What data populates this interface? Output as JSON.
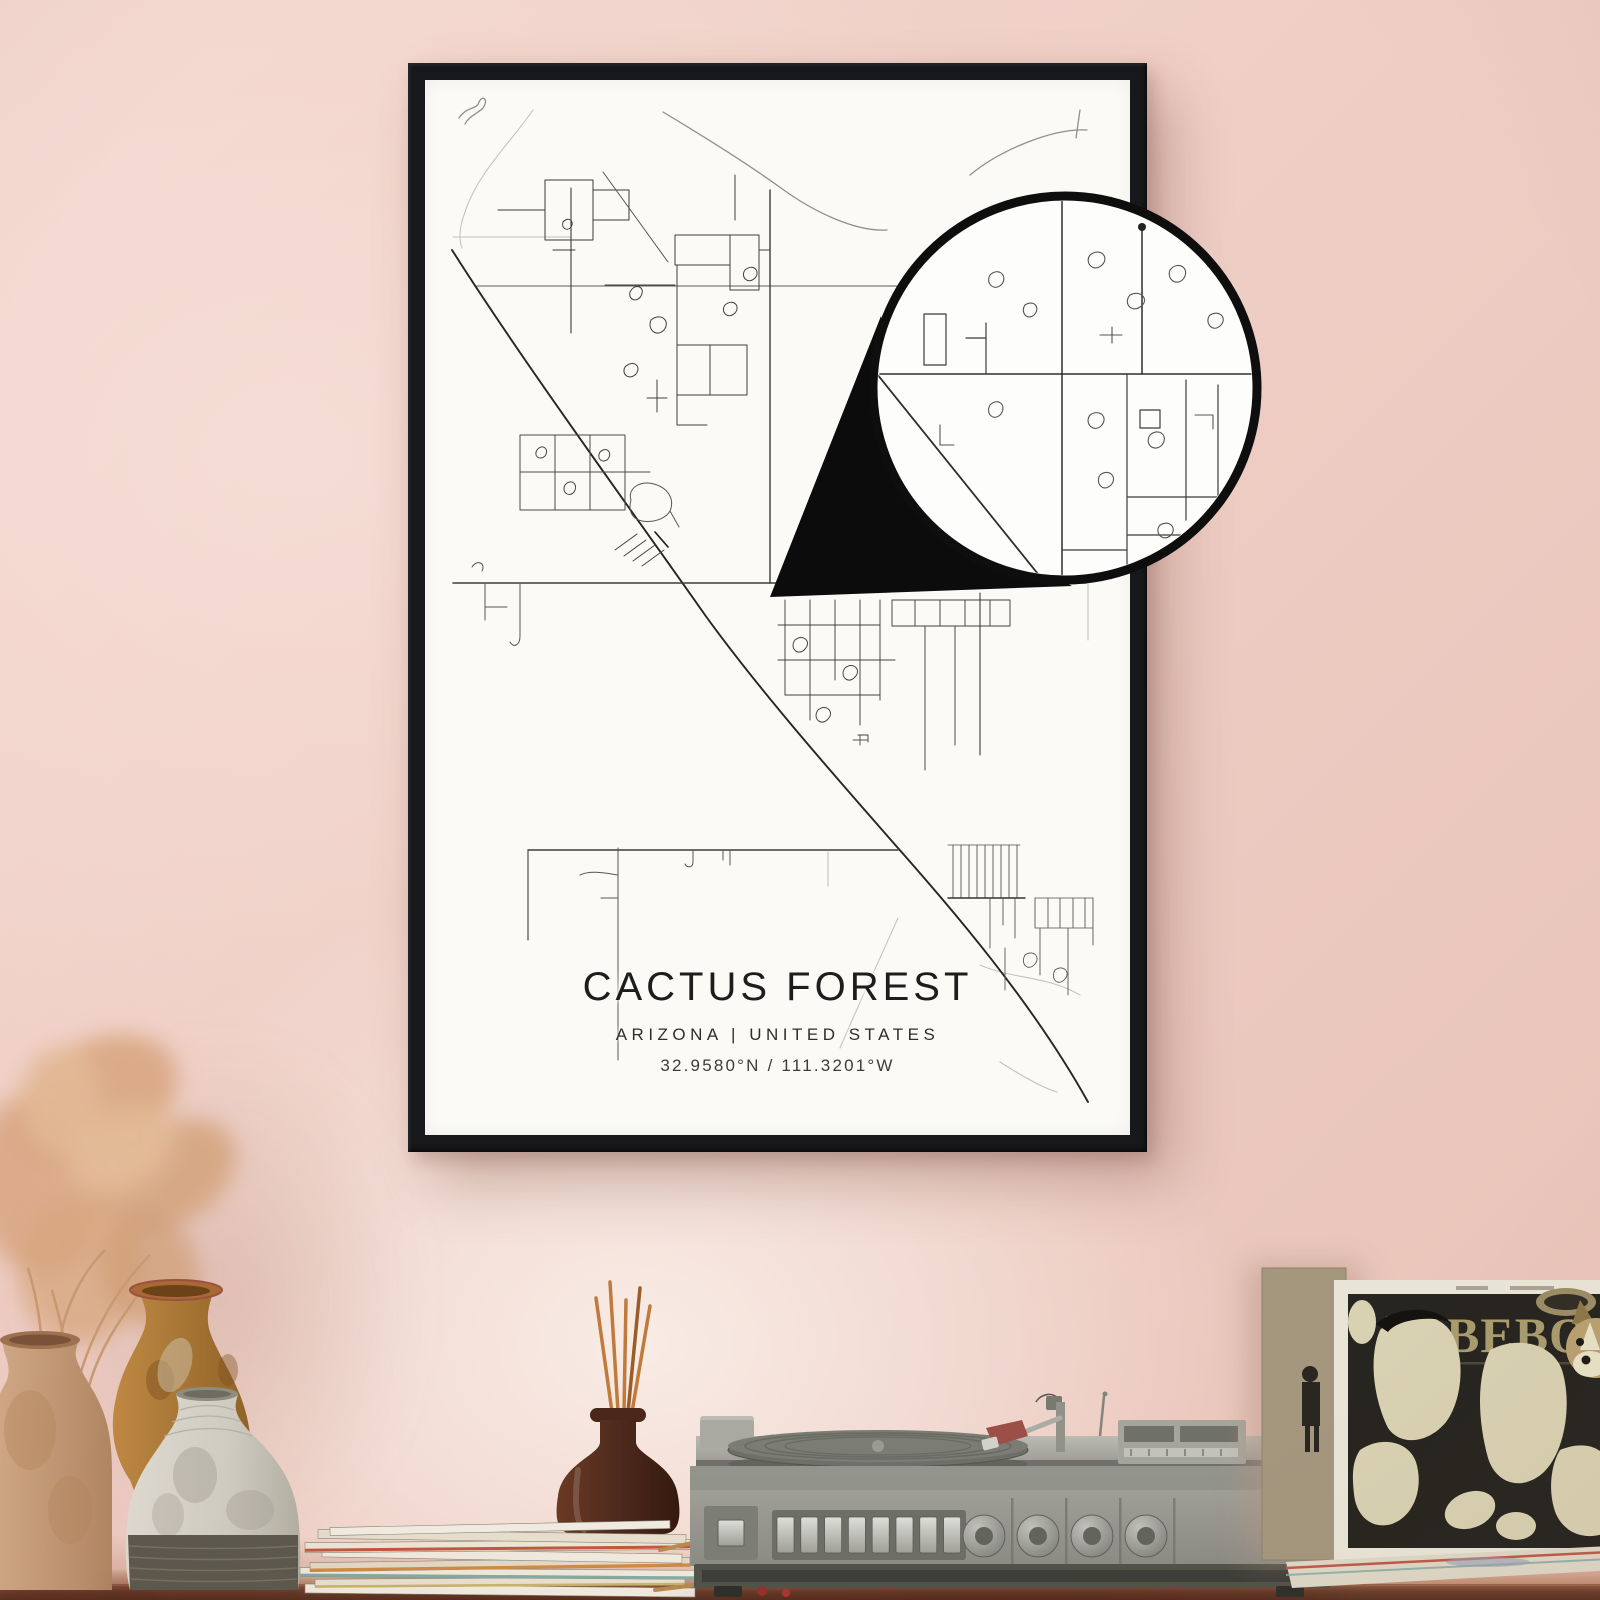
{
  "poster": {
    "title": "CACTUS FOREST",
    "subtitle": "ARIZONA | UNITED STATES",
    "coordinates": "32.9580°N / 111.3201°W"
  },
  "album": {
    "title_line1": "MEET",
    "title_line2": "THE",
    "title_line3": "BEBOP"
  },
  "colors": {
    "wall_pink": "#eecdc4",
    "frame_black": "#17181b",
    "poster_paper": "#fbfaf7",
    "map_line": "#3a3a3a",
    "callout_black": "#0d0d0d",
    "table_wood": "#6b3f2c",
    "player_gray": "#9c9c94",
    "album_art_bg": "#272520",
    "album_text_khaki": "#a69a6e",
    "vase_tan": "#c9a183",
    "vase_ochre": "#b5823d",
    "diffuser_brown": "#4e2a1c"
  }
}
